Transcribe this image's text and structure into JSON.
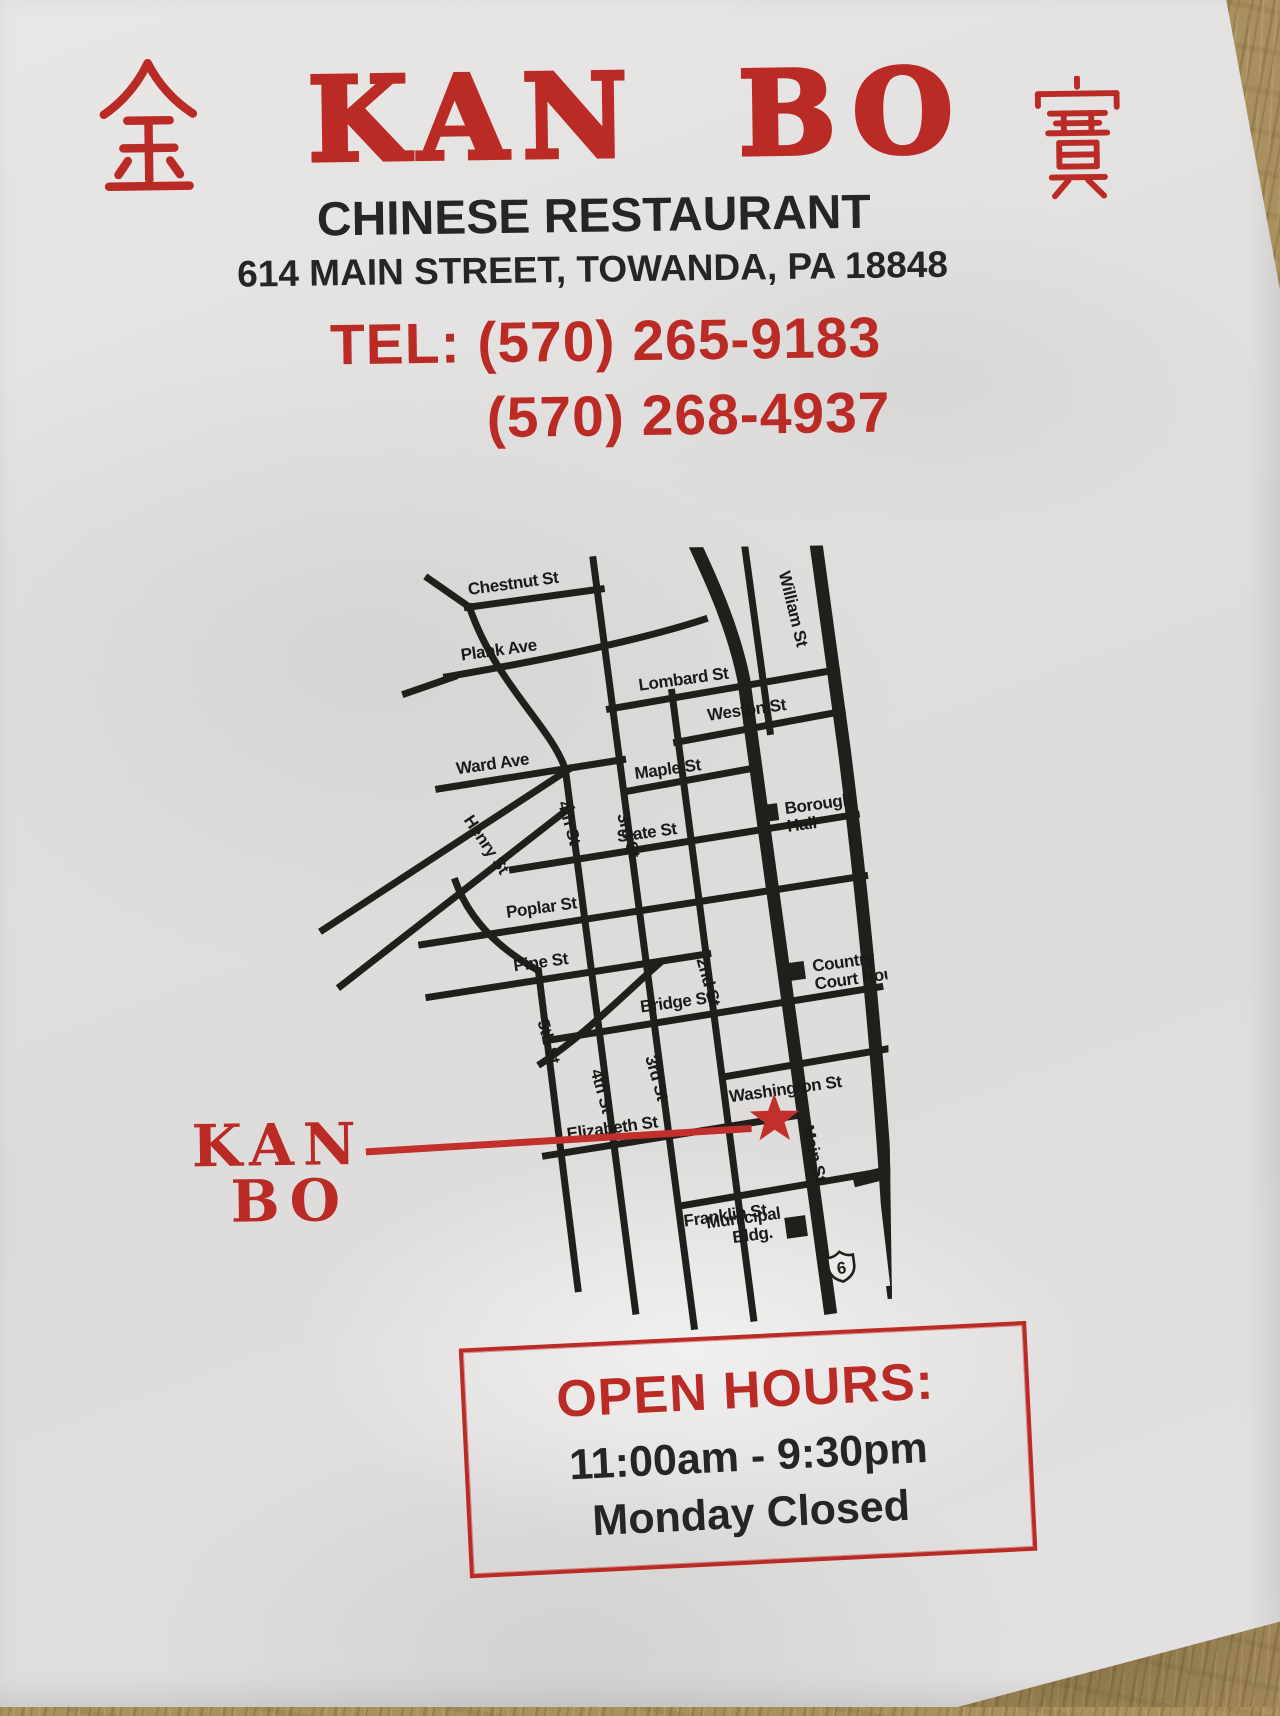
{
  "header": {
    "left_character": "金",
    "right_character": "寶",
    "name": "KAN BO",
    "subtitle": "CHINESE RESTAURANT",
    "address": "614 MAIN STREET, TOWANDA, PA 18848",
    "tel_line1": "TEL: (570) 265-9183",
    "tel_line2": "(570) 268-4937"
  },
  "map": {
    "marker": {
      "line1": "KAN",
      "line2": "BO"
    },
    "streets": {
      "chestnut": "Chestnut St",
      "plank": "Plank Ave",
      "lombard": "Lombard St",
      "ward": "Ward Ave",
      "maple": "Maple St",
      "weston": "Weston St",
      "henry": "Henry St",
      "state": "State St",
      "poplar": "Poplar St",
      "pine": "Pine St",
      "bridge": "Bridge St",
      "washington": "Washington St",
      "elizabeth": "Elizabeth St",
      "franklin": "Franklin St",
      "william": "William St",
      "main": "Main St",
      "fifth": "5th St",
      "fourth": "4th St",
      "third": "3rd St",
      "second": "2nd St"
    },
    "landmarks": {
      "borough_hall": [
        "Borough",
        "Hall"
      ],
      "court_house": [
        "Country",
        "Court House"
      ],
      "municipal": [
        "Municipal",
        "Bldg."
      ],
      "route": "6"
    }
  },
  "hours": {
    "title": "OPEN HOURS:",
    "time": "11:00am - 9:30pm",
    "closed": "Monday Closed"
  }
}
